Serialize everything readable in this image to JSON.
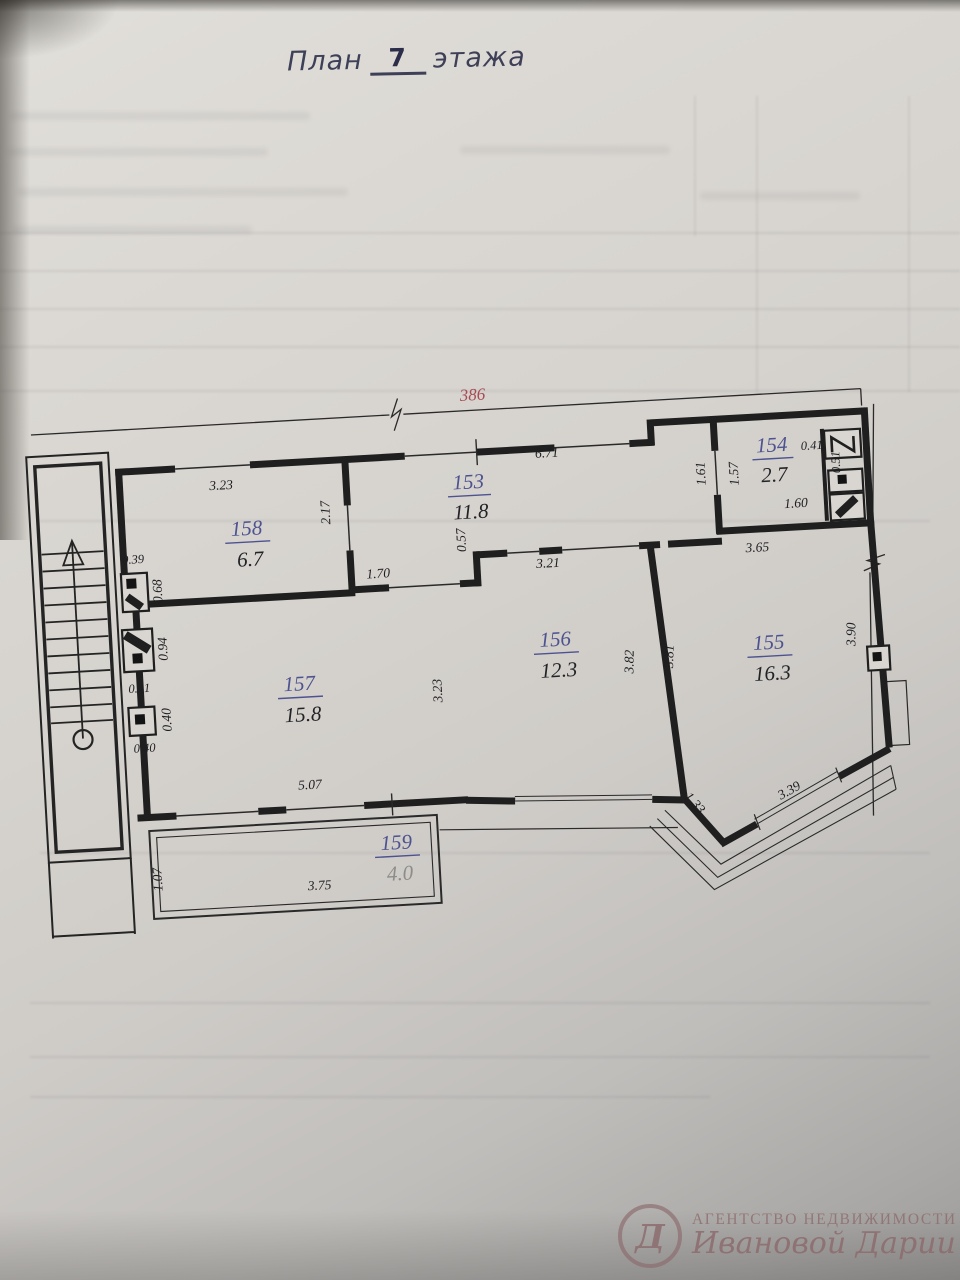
{
  "title": {
    "prefix": "План",
    "floor_number": "7",
    "suffix": "этажа"
  },
  "annotation_number": "386",
  "rooms": [
    {
      "number": "153",
      "area": "11.8"
    },
    {
      "number": "154",
      "area": "2.7"
    },
    {
      "number": "155",
      "area": "16.3"
    },
    {
      "number": "156",
      "area": "12.3"
    },
    {
      "number": "157",
      "area": "15.8"
    },
    {
      "number": "158",
      "area": "6.7"
    },
    {
      "number": "159",
      "area": "4.0"
    }
  ],
  "dims": {
    "r158_top": "3.23",
    "hall_top": "6.71",
    "r154_left_outer": "1.61",
    "r154_left_inner": "1.57",
    "r154_niche_width": "0.41",
    "r154_niche_height": "0.51",
    "r154_bottom": "1.60",
    "r158_right": "2.17",
    "shaft_width": "0.39",
    "shaft_h1": "0.68",
    "shaft_h2": "0.94",
    "shaft_gap": "0.41",
    "shaft_h3": "0.40",
    "shaft_w2": "0.40",
    "hall_opening": "1.70",
    "hall_step": "0.57",
    "r156_top": "3.21",
    "r155_top": "3.65",
    "r156_right_inner": "3.82",
    "r156_right_outer": "3.81",
    "r155_right": "3.90",
    "r157_right": "3.23",
    "r157_bottom": "5.07",
    "r159_left": "1.07",
    "r159_bottom": "3.75",
    "r155_corner": "1.33",
    "r155_diagonal": "3.39"
  },
  "watermark": {
    "line1": "АГЕНТСТВО НЕДВИЖИМОСТИ",
    "line2": "Ивановой Дарии",
    "monogram": "Д"
  }
}
